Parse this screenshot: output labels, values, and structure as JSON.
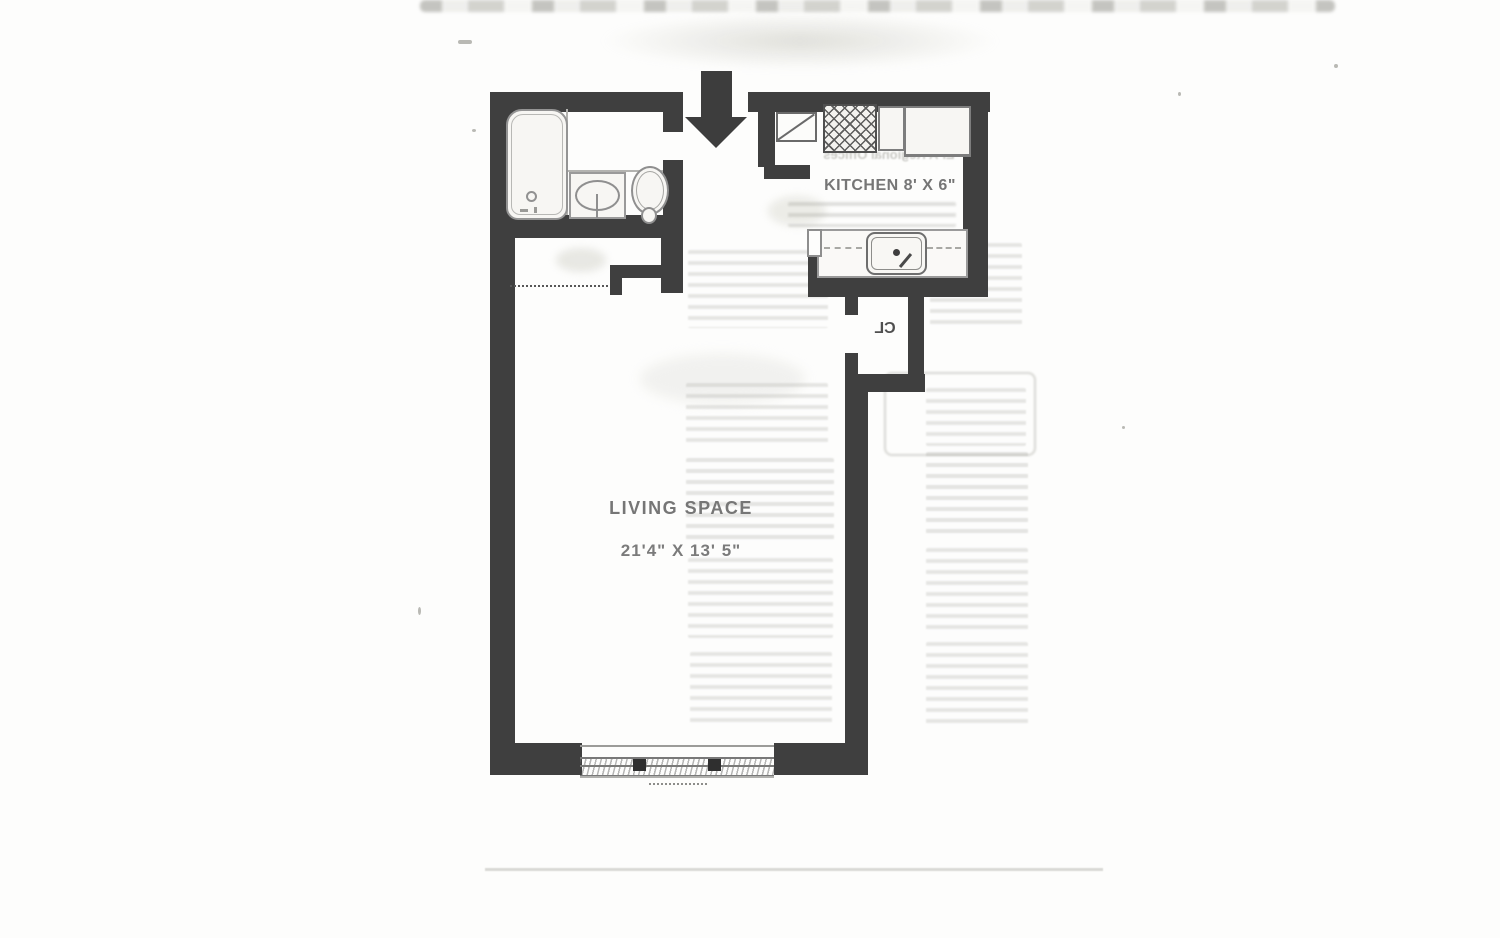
{
  "page": {
    "colors": {
      "paper": "#fdfdfc",
      "wall": "#3f3f3f",
      "label": "#767676",
      "fixture_line": "#8f8f8f",
      "bleedthrough": "#a8a8a2"
    }
  },
  "floor_plan": {
    "entry": {
      "icon": "entry-arrow-down"
    },
    "rooms": {
      "kitchen": {
        "label": "KITCHEN 8' X 6\"",
        "fixtures": [
          "stove-icon",
          "dishwasher-icon",
          "refrigerator-icon",
          "kitchen-sink-icon",
          "door-swing-icon"
        ]
      },
      "living_space": {
        "label": "LIVING SPACE",
        "dimensions": "21'4\" X 13' 5\""
      },
      "closet": {
        "label": "CL"
      },
      "bathroom": {
        "fixtures": [
          "bathtub-icon",
          "bathroom-sink-icon",
          "toilet-icon"
        ]
      }
    },
    "features": [
      "window-icon",
      "closet-rod-dotted-line"
    ]
  },
  "artifacts": {
    "bleedthrough_heading": "EPA Regional Offices"
  }
}
